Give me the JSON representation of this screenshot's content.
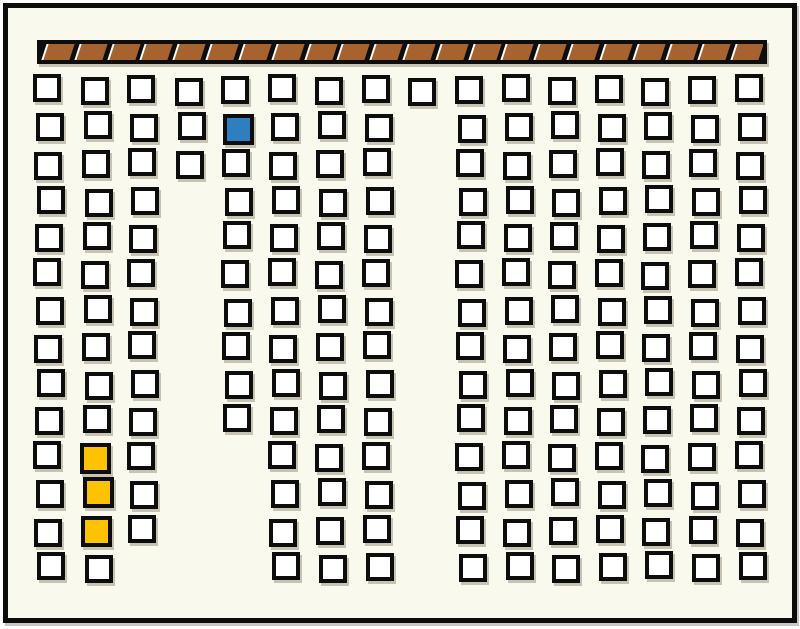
{
  "palette": {
    "page_background": "#ffffff",
    "surface": "#faf9ed",
    "ink": "#0d0d0d",
    "seat_fill": "#ffffff",
    "bar_brown": "#a6622f",
    "bar_separator_highlight": "#ffffff",
    "selected_blue": "#2e7fbf",
    "marked_yellow": "#fdc303",
    "shadow": "rgba(120,112,95,0.4)"
  },
  "frame": {
    "x": 3,
    "y": 3,
    "width": 794,
    "height": 620,
    "border_width": 5
  },
  "hatched_bar": {
    "x": 37,
    "y": 40,
    "width": 730,
    "height": 24,
    "border_width": 4,
    "segment_count": 22,
    "slant_deg": -18
  },
  "grid": {
    "square_size": 28,
    "square_border_width": 4,
    "highlight_square_size": 31,
    "row_y": [
      76,
      113,
      150,
      187,
      223,
      260,
      297,
      333,
      370,
      406,
      443,
      480,
      517,
      553
    ],
    "columns": [
      {
        "x": 35,
        "rows": [
          0,
          13
        ]
      },
      {
        "x": 83,
        "rows": [
          0,
          13
        ]
      },
      {
        "x": 129,
        "rows": [
          0,
          12
        ]
      },
      {
        "x": 177,
        "rows": [
          0,
          2
        ]
      },
      {
        "x": 223,
        "rows": [
          0,
          9
        ]
      },
      {
        "x": 270,
        "rows": [
          0,
          13
        ]
      },
      {
        "x": 317,
        "rows": [
          0,
          13
        ]
      },
      {
        "x": 364,
        "rows": [
          0,
          13
        ]
      },
      {
        "x": 410,
        "rows": [
          0,
          0
        ]
      },
      {
        "x": 457,
        "rows": [
          0,
          13
        ]
      },
      {
        "x": 504,
        "rows": [
          0,
          13
        ]
      },
      {
        "x": 550,
        "rows": [
          0,
          13
        ]
      },
      {
        "x": 597,
        "rows": [
          0,
          13
        ]
      },
      {
        "x": 643,
        "rows": [
          0,
          13
        ]
      },
      {
        "x": 690,
        "rows": [
          0,
          13
        ]
      },
      {
        "x": 737,
        "rows": [
          0,
          13
        ]
      }
    ],
    "highlights": [
      {
        "col": 4,
        "row": 1,
        "color_key": "selected_blue",
        "name": "seat-square-selected-blue"
      },
      {
        "col": 1,
        "row": 10,
        "color_key": "marked_yellow",
        "name": "seat-square-marked-yellow"
      },
      {
        "col": 1,
        "row": 11,
        "color_key": "marked_yellow",
        "name": "seat-square-marked-yellow"
      },
      {
        "col": 1,
        "row": 12,
        "color_key": "marked_yellow",
        "name": "seat-square-marked-yellow"
      }
    ]
  }
}
